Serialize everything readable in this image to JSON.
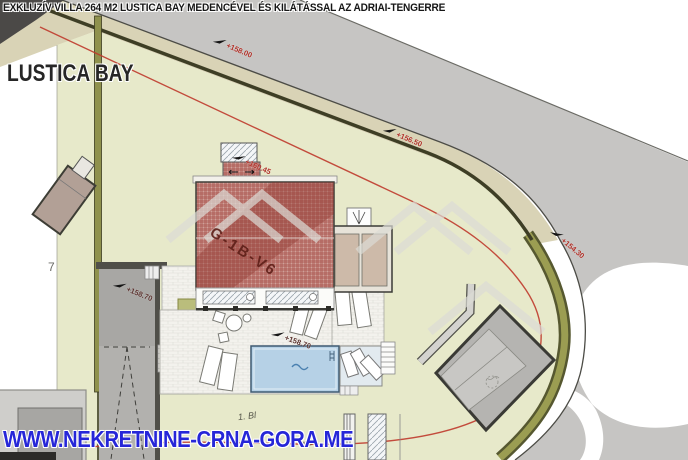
{
  "title": "EXKLUZÍV VILLA 264 M2 LUSTICA BAY MEDENCÉVEL ÉS KILÁTÁSSAL AZ ADRIAI-TENGERRE",
  "branding": {
    "location_label": "LUSTICA BAY",
    "watermark_url": "WWW.NEKRETNINE-CRNA-GORA.ME"
  },
  "plan": {
    "building_label": "G-1B-V6",
    "parcel_number": "7",
    "elevation_markers": [
      "+158.00",
      "+156.50",
      "+154.30",
      "+160.45",
      "+158.70",
      "+158.70"
    ],
    "annotations": [
      "1. Bl",
      "m2"
    ]
  },
  "colors": {
    "marker_red": "#b03028",
    "marker_dark": "#5a322e",
    "watermark_blue": "#2626d8",
    "roof_red": "#cfa09a",
    "parcel_green": "#e7e9ca",
    "road_gray": "#c6c5c3",
    "hedge_olive": "#94964f",
    "sidewalk_beige": "#d9d3b6",
    "pool_blue": "#b6d1e6"
  }
}
